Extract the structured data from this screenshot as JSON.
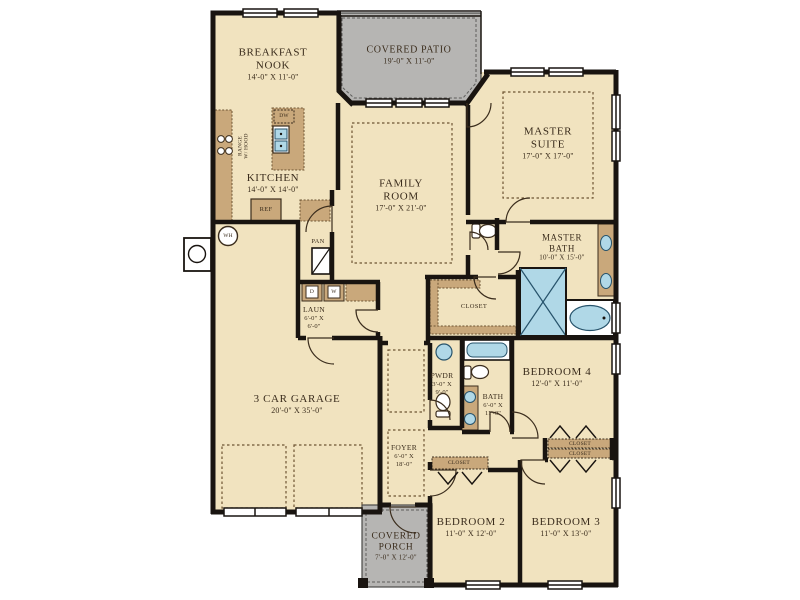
{
  "plan": {
    "title": "single-story home floor plan",
    "colors": {
      "floor": "#f1e3bf",
      "outdoor": "#b6b5b3",
      "wall": "#191410",
      "cabinet": "#c9a87b",
      "fixture_blue": "#b0d8e7",
      "text": "#3b2d1d"
    },
    "rooms": {
      "breakfast_nook": {
        "line1": "BREAKFAST",
        "line2": "NOOK",
        "dims": "14'-0\" X 11'-0\""
      },
      "covered_patio": {
        "line1": "COVERED PATIO",
        "dims": "19'-0\" X 11'-0\""
      },
      "master_suite": {
        "line1": "MASTER",
        "line2": "SUITE",
        "dims": "17'-0\" X 17'-0\""
      },
      "kitchen": {
        "line1": "KITCHEN",
        "dims": "14'-0\" X 14'-0\""
      },
      "family_room": {
        "line1": "FAMILY",
        "line2": "ROOM",
        "dims": "17'-0\" X 21'-0\""
      },
      "master_bath": {
        "line1": "MASTER",
        "line2": "BATH",
        "dims": "10'-0\" X 15'-0\""
      },
      "master_closet": {
        "line1": "CLOSET"
      },
      "laundry": {
        "line1": "LAUN",
        "dims_l1": "6'-0\" X",
        "dims_l2": "6'-0\""
      },
      "pantry": {
        "line1": "PAN"
      },
      "powder": {
        "line1": "PWDR",
        "dims_l1": "3'-0\" X",
        "dims_l2": "9'-0\""
      },
      "bath": {
        "line1": "BATH",
        "dims_l1": "6'-0\" X",
        "dims_l2": "11'-0\""
      },
      "bedroom4": {
        "line1": "BEDROOM 4",
        "dims": "12'-0\" X 11'-0\""
      },
      "garage": {
        "line1": "3 CAR GARAGE",
        "dims": "20'-0\" X 35'-0\""
      },
      "foyer": {
        "line1": "FOYER",
        "dims_l1": "6'-0\" X",
        "dims_l2": "18'-0\""
      },
      "bedroom2_closet": {
        "line1": "CLOSET"
      },
      "bedroom4_closet": {
        "line1": "CLOSET"
      },
      "bedroom3_closet": {
        "line1": "CLOSET"
      },
      "covered_porch": {
        "line1": "COVERED",
        "line2": "PORCH",
        "dims": "7'-0\" X 12'-0\""
      },
      "bedroom2": {
        "line1": "BEDROOM 2",
        "dims": "11'-0\" X 12'-0\""
      },
      "bedroom3": {
        "line1": "BEDROOM 3",
        "dims": "11'-0\" X 13'-0\""
      }
    },
    "appliances": {
      "dishwasher": "DW",
      "refrigerator": "REF",
      "water_heater": "WH",
      "dryer": "D",
      "washer": "W",
      "range_line1": "RANGE",
      "range_line2": "W/ HOOD"
    }
  }
}
